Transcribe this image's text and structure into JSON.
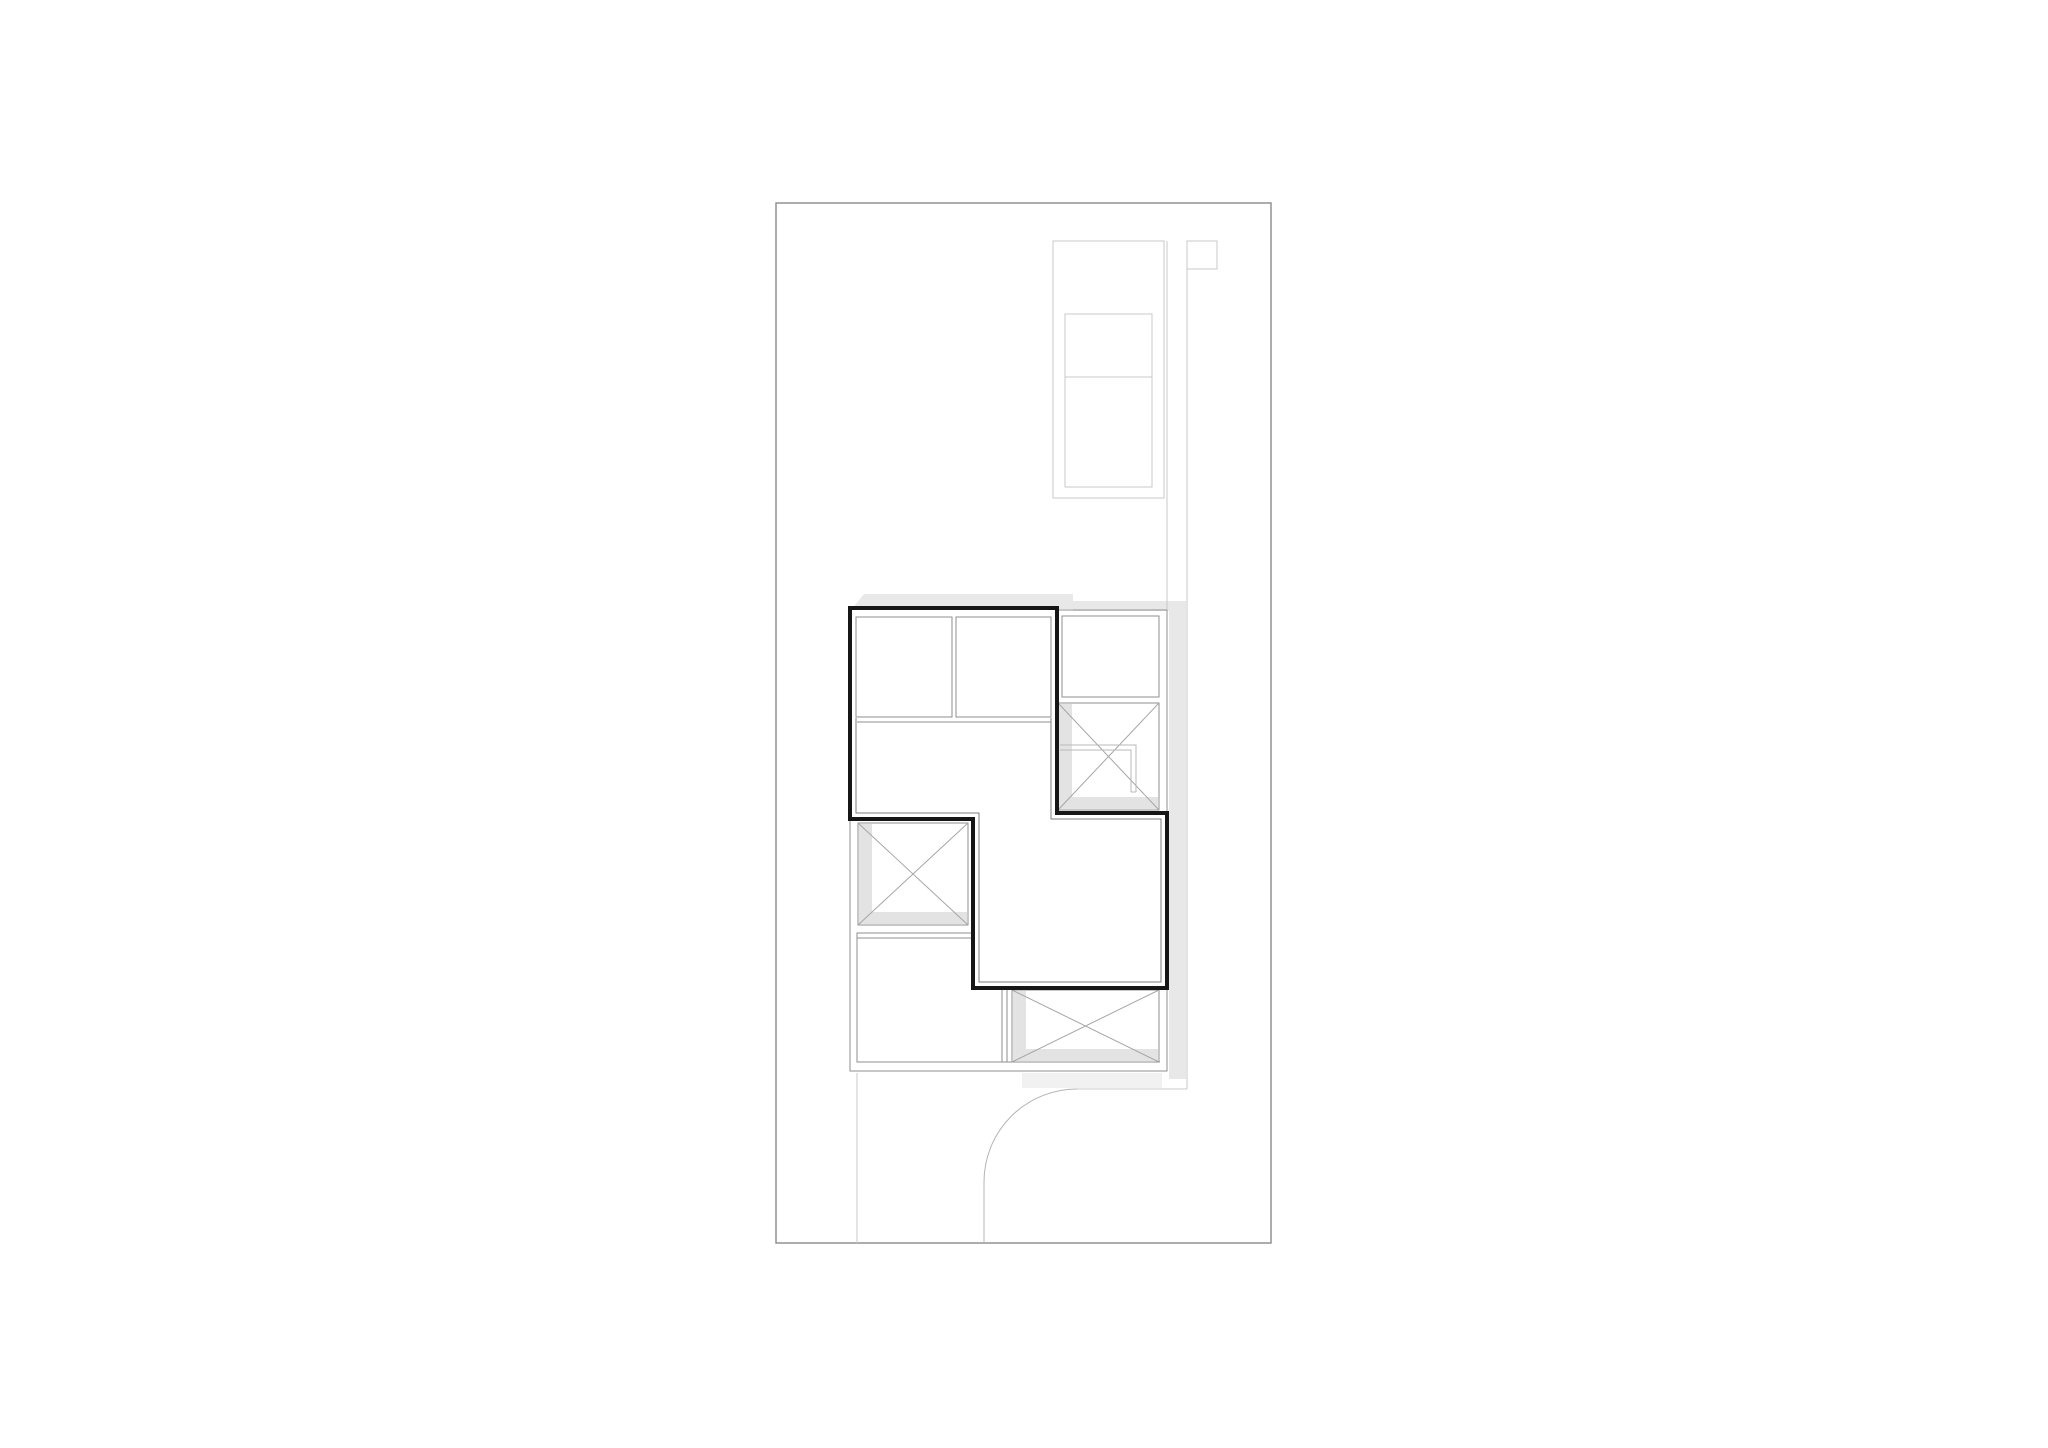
{
  "canvas": {
    "width": 2048,
    "height": 1448,
    "background": "#ffffff"
  },
  "drawing": {
    "colors": {
      "boundary": "#8a8a8a",
      "site": "#c9c9c9",
      "path": "#b4b4b4",
      "plan": "#8f8f8f",
      "diag": "#a6a6a6",
      "inset": "#7e7e7e",
      "wall": "#161616",
      "lshape": "#b8b8b8",
      "shadow": "#e8e8e8",
      "shadowIn": "#e3e3e3",
      "shadowLt": "#f1f1f1",
      "white": "#ffffff"
    },
    "shapes": [
      {
        "name": "property-boundary",
        "type": "rect",
        "x": 776,
        "y": 203,
        "w": 495,
        "h": 1040,
        "stroke": "boundary",
        "sw": 1.4
      },
      {
        "name": "shadow-roof-top",
        "type": "polygon",
        "pts": [
          [
            864,
            594
          ],
          [
            1073,
            594
          ],
          [
            1073,
            609
          ],
          [
            852,
            609
          ]
        ],
        "fill": "shadow"
      },
      {
        "name": "shadow-roof-top-right",
        "type": "rect",
        "x": 1073,
        "y": 601,
        "w": 111,
        "h": 10,
        "fill": "shadow"
      },
      {
        "name": "shadow-right-band",
        "type": "rect",
        "x": 1169,
        "y": 601,
        "w": 17,
        "h": 478,
        "fill": "shadow"
      },
      {
        "name": "shadow-bottom-right",
        "type": "rect",
        "x": 1022,
        "y": 1073,
        "w": 140,
        "h": 15,
        "fill": "shadowLt"
      },
      {
        "name": "garage-outline",
        "type": "rect",
        "x": 1053,
        "y": 241,
        "w": 111,
        "h": 257,
        "stroke": "site",
        "sw": 1
      },
      {
        "name": "garage-inner-bay",
        "type": "rect",
        "x": 1065,
        "y": 314,
        "w": 87,
        "h": 173,
        "stroke": "site",
        "sw": 1
      },
      {
        "name": "garage-bay-divider",
        "type": "line",
        "x1": 1065,
        "y1": 377,
        "x2": 1152,
        "y2": 377,
        "stroke": "site",
        "sw": 1
      },
      {
        "name": "entry-marker-square",
        "type": "rect",
        "x": 1187,
        "y": 241,
        "w": 30,
        "h": 28,
        "stroke": "site",
        "sw": 1
      },
      {
        "name": "path-edge-west",
        "type": "line",
        "x1": 1167,
        "y1": 241,
        "x2": 1167,
        "y2": 609,
        "stroke": "site",
        "sw": 1
      },
      {
        "name": "path-edge-east",
        "type": "line",
        "x1": 1187,
        "y1": 241,
        "x2": 1187,
        "y2": 1089,
        "stroke": "site",
        "sw": 1
      },
      {
        "name": "path-edge-south",
        "type": "line",
        "x1": 1077,
        "y1": 1089,
        "x2": 1187,
        "y2": 1089,
        "stroke": "site",
        "sw": 1
      },
      {
        "name": "driveway-arc",
        "type": "path",
        "d": "M 1077 1089 A 93 93 0 0 0 984 1182",
        "stroke": "path",
        "sw": 1
      },
      {
        "name": "driveway-edge",
        "type": "line",
        "x1": 984,
        "y1": 1182,
        "x2": 984,
        "y2": 1243,
        "stroke": "path",
        "sw": 1
      },
      {
        "name": "garden-path-line",
        "type": "line",
        "x1": 857,
        "y1": 1073,
        "x2": 857,
        "y2": 1243,
        "stroke": "site",
        "sw": 1
      },
      {
        "name": "ground-floor-outline",
        "type": "rect",
        "x": 850,
        "y": 610,
        "w": 317,
        "h": 461,
        "stroke": "plan",
        "sw": 1
      },
      {
        "name": "ground-floor-bottom-inner-line",
        "type": "line",
        "x1": 857,
        "y1": 1062,
        "x2": 1160,
        "y2": 1062,
        "stroke": "plan",
        "sw": 1
      },
      {
        "name": "skylight-box-ne",
        "type": "rect",
        "x": 1058,
        "y": 703,
        "w": 101,
        "h": 107,
        "fill": "white",
        "stroke": "plan",
        "sw": 1
      },
      {
        "name": "skylight-ne-inner-shadow-left",
        "type": "rect",
        "x": 1059,
        "y": 704,
        "w": 13,
        "h": 105,
        "fill": "shadowIn"
      },
      {
        "name": "skylight-ne-inner-shadow-bottom",
        "type": "rect",
        "x": 1059,
        "y": 797,
        "w": 99,
        "h": 12,
        "fill": "shadowIn"
      },
      {
        "name": "skylight-ne-diagonal-a",
        "type": "line",
        "x1": 1058,
        "y1": 703,
        "x2": 1159,
        "y2": 810,
        "stroke": "diag",
        "sw": 1
      },
      {
        "name": "skylight-ne-diagonal-b",
        "type": "line",
        "x1": 1058,
        "y1": 810,
        "x2": 1159,
        "y2": 703,
        "stroke": "diag",
        "sw": 1
      },
      {
        "name": "stair-detail-outer",
        "type": "polyline",
        "pts": [
          [
            1060,
            745
          ],
          [
            1136,
            745
          ],
          [
            1136,
            792
          ]
        ],
        "stroke": "lshape",
        "sw": 1
      },
      {
        "name": "stair-detail-inner",
        "type": "polyline",
        "pts": [
          [
            1060,
            750
          ],
          [
            1131,
            750
          ],
          [
            1131,
            792
          ]
        ],
        "stroke": "lshape",
        "sw": 1
      },
      {
        "name": "stair-detail-foot",
        "type": "line",
        "x1": 1131,
        "y1": 792,
        "x2": 1136,
        "y2": 792,
        "stroke": "lshape",
        "sw": 1
      },
      {
        "name": "room-ne-veranda",
        "type": "rect",
        "x": 1062,
        "y": 616,
        "w": 97,
        "h": 81,
        "fill": "white",
        "stroke": "plan",
        "sw": 1
      },
      {
        "name": "skylight-box-west",
        "type": "rect",
        "x": 858,
        "y": 823,
        "w": 110,
        "h": 102,
        "fill": "white",
        "stroke": "plan",
        "sw": 1
      },
      {
        "name": "skylight-w-inner-shadow-left",
        "type": "rect",
        "x": 859,
        "y": 824,
        "w": 13,
        "h": 100,
        "fill": "shadowIn"
      },
      {
        "name": "skylight-w-inner-shadow-bottom",
        "type": "rect",
        "x": 859,
        "y": 912,
        "w": 108,
        "h": 12,
        "fill": "shadowIn"
      },
      {
        "name": "skylight-w-diagonal-a",
        "type": "line",
        "x1": 858,
        "y1": 823,
        "x2": 968,
        "y2": 925,
        "stroke": "diag",
        "sw": 1
      },
      {
        "name": "skylight-w-diagonal-b",
        "type": "line",
        "x1": 858,
        "y1": 925,
        "x2": 968,
        "y2": 823,
        "stroke": "diag",
        "sw": 1
      },
      {
        "name": "room-sw",
        "type": "rect",
        "x": 857,
        "y": 933,
        "w": 150,
        "h": 129,
        "fill": "white",
        "stroke": "plan",
        "sw": 1
      },
      {
        "name": "room-sw-inner-face",
        "type": "polyline",
        "pts": [
          [
            857,
            938
          ],
          [
            1002,
            938
          ],
          [
            1002,
            1062
          ]
        ],
        "stroke": "plan",
        "sw": 1
      },
      {
        "name": "skylight-box-se",
        "type": "rect",
        "x": 1012,
        "y": 990,
        "w": 147,
        "h": 72,
        "fill": "white",
        "stroke": "plan",
        "sw": 1
      },
      {
        "name": "skylight-se-inner-shadow-left",
        "type": "rect",
        "x": 1013,
        "y": 991,
        "w": 13,
        "h": 70,
        "fill": "shadowIn"
      },
      {
        "name": "skylight-se-inner-shadow-bottom",
        "type": "rect",
        "x": 1013,
        "y": 1049,
        "w": 145,
        "h": 12,
        "fill": "shadowIn"
      },
      {
        "name": "skylight-se-diagonal-a",
        "type": "line",
        "x1": 1012,
        "y1": 990,
        "x2": 1159,
        "y2": 1062,
        "stroke": "diag",
        "sw": 1
      },
      {
        "name": "skylight-se-diagonal-b",
        "type": "line",
        "x1": 1012,
        "y1": 1062,
        "x2": 1159,
        "y2": 990,
        "stroke": "diag",
        "sw": 1
      },
      {
        "name": "upper-floor-outline",
        "type": "polygon",
        "pts": [
          [
            850,
            608
          ],
          [
            1057,
            608
          ],
          [
            1057,
            813
          ],
          [
            1167,
            813
          ],
          [
            1167,
            988
          ],
          [
            973,
            988
          ],
          [
            973,
            819
          ],
          [
            850,
            819
          ]
        ],
        "fill": "white",
        "stroke": "wall",
        "sw": 4
      },
      {
        "name": "upper-floor-inner-face",
        "type": "polyline",
        "pts": [
          [
            856,
            718
          ],
          [
            856,
            813
          ],
          [
            979,
            813
          ],
          [
            979,
            982
          ],
          [
            1161,
            982
          ],
          [
            1161,
            819
          ],
          [
            1051,
            819
          ],
          [
            1051,
            718
          ]
        ],
        "stroke": "inset",
        "sw": 1
      },
      {
        "name": "room-nw-a",
        "type": "rect",
        "x": 856,
        "y": 617,
        "w": 96,
        "h": 100,
        "fill": "white",
        "stroke": "plan",
        "sw": 1
      },
      {
        "name": "room-nw-b",
        "type": "rect",
        "x": 956,
        "y": 617,
        "w": 95,
        "h": 100,
        "fill": "white",
        "stroke": "plan",
        "sw": 1
      },
      {
        "name": "rooms-ledge-line",
        "type": "line",
        "x1": 857,
        "y1": 722,
        "x2": 1051,
        "y2": 722,
        "stroke": "plan",
        "sw": 1
      }
    ]
  }
}
